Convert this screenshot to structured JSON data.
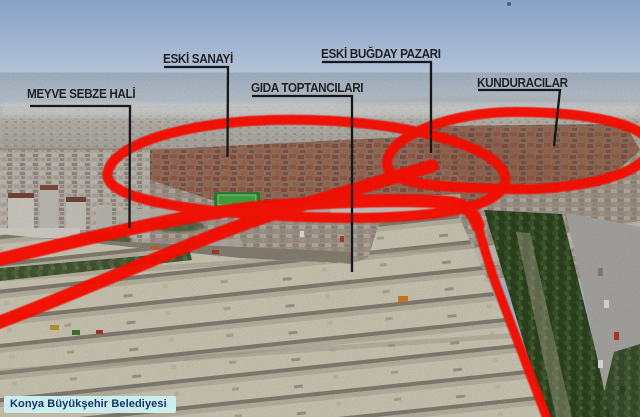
{
  "labels": {
    "meyve": {
      "text": "MEYVE SEBZE HALİ"
    },
    "sanayi": {
      "text": "ESKİ SANAYİ"
    },
    "gida": {
      "text": "GIDA TOPTANCILARI"
    },
    "bugday": {
      "text": "ESKİ BUĞDAY PAZARI"
    },
    "kundura": {
      "text": "KUNDURACILAR"
    }
  },
  "watermark": {
    "text": "Konya Büyükşehir Belediyesi"
  },
  "colors": {
    "highlight_red": "#f20800",
    "pointer_line": "#17171b",
    "label_text": "#1f1f23",
    "watermark_bg": "#cdecee",
    "watermark_text": "#15356b",
    "sky_top": "#88a2c6",
    "sky_horizon": "#e3e6e6"
  }
}
